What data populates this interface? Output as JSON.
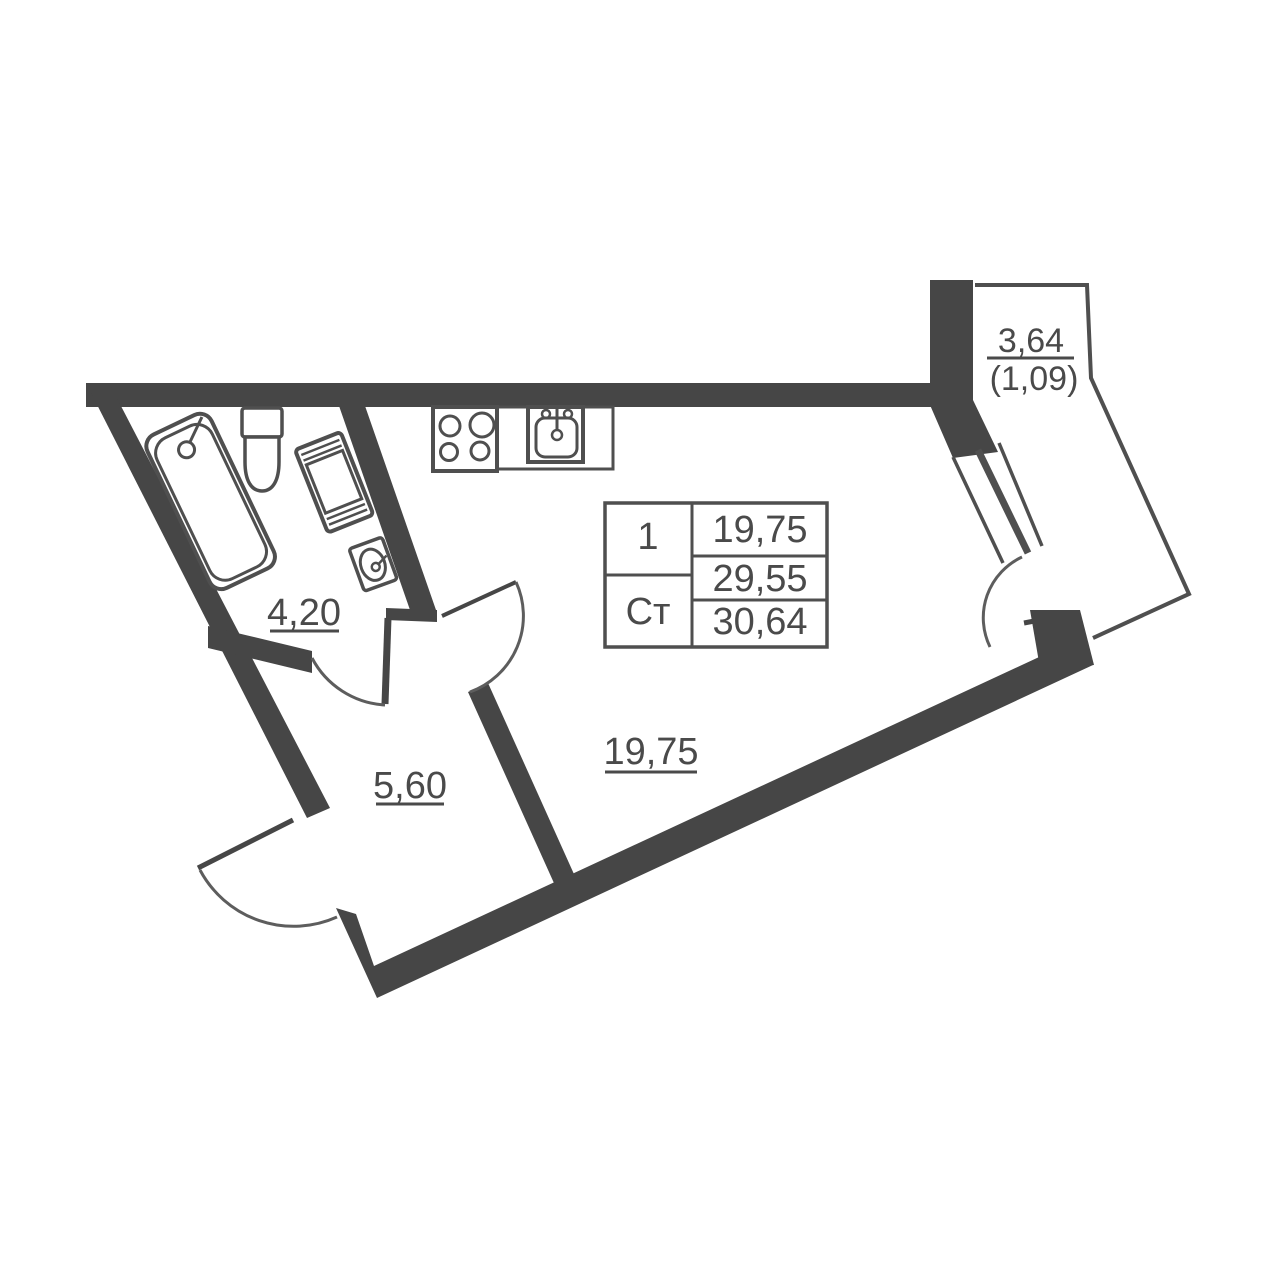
{
  "colors": {
    "wall": "#464646",
    "line": "#4f4f4f",
    "arc": "#5d5d5d",
    "text": "#4a4a4a",
    "bg": "#ffffff"
  },
  "rooms": [
    {
      "name": "bathroom",
      "area": "4,20"
    },
    {
      "name": "hallway",
      "area": "5,60"
    },
    {
      "name": "living-room",
      "area": "19,75"
    },
    {
      "name": "balcony",
      "area": "3,64",
      "area_with_coefficient": "(1,09)"
    }
  ],
  "info_table": {
    "room_count": "1",
    "apartment_type": "Ст",
    "living_area": "19,75",
    "area_no_balcony": "29,55",
    "total_area": "30,64"
  }
}
